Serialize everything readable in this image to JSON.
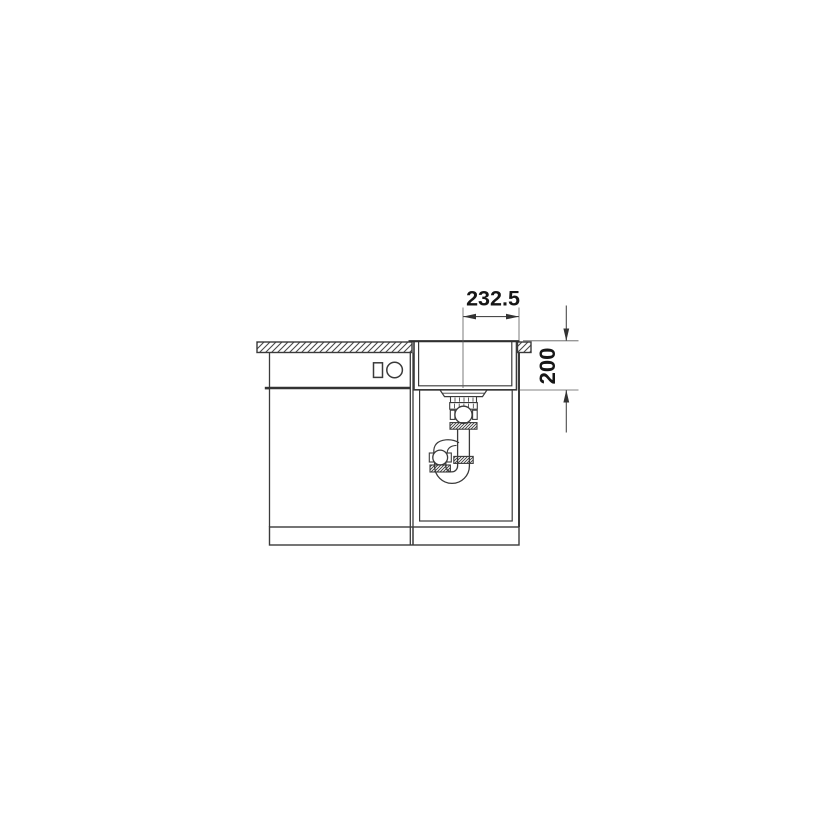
{
  "drawing": {
    "dimensions": {
      "drain_offset_width": {
        "label": "232.5"
      },
      "bowl_depth": {
        "label": "200"
      }
    },
    "colors": {
      "line": "#3a3a3a",
      "dim_line": "#4a4a4a",
      "text": "#161616",
      "background": "#ffffff"
    }
  }
}
